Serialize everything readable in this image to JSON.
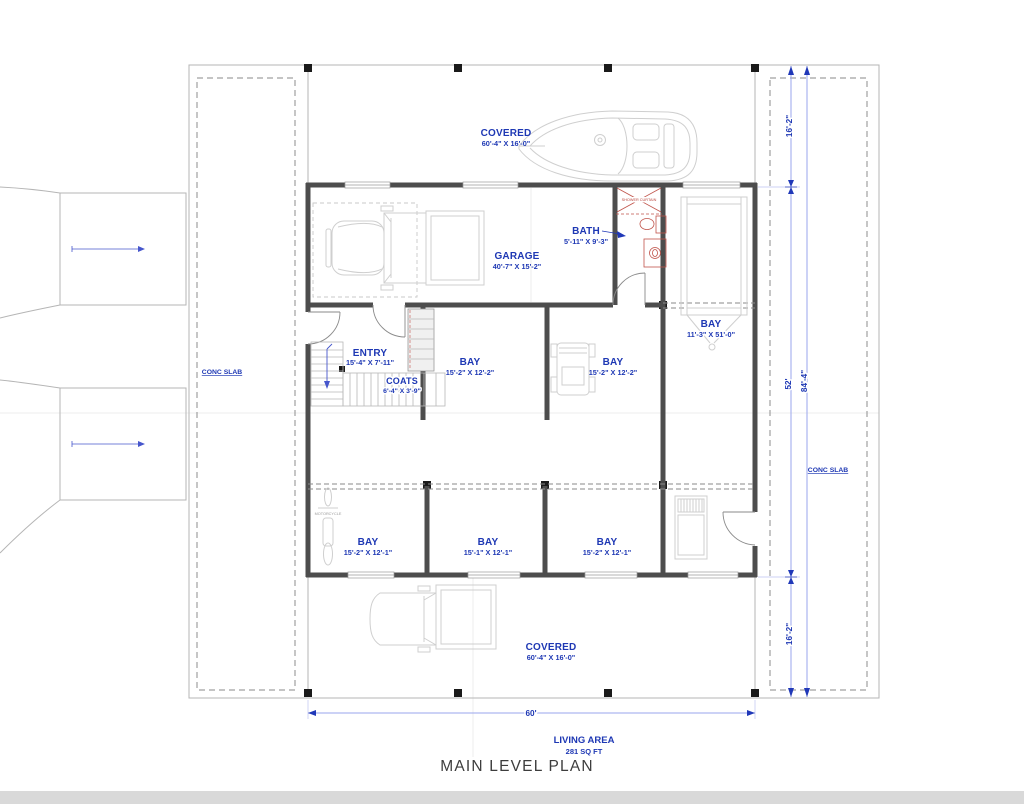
{
  "plan": {
    "title": "MAIN LEVEL PLAN",
    "living_area": {
      "label": "LIVING AREA",
      "value": "281 SQ FT"
    },
    "rooms": {
      "covered_top": {
        "name": "COVERED",
        "dims": "60'-4\" X 16'-0\""
      },
      "garage": {
        "name": "GARAGE",
        "dims": "40'-7\" X 15'-2\""
      },
      "bath": {
        "name": "BATH",
        "dims": "5'-11\" X 9'-3\""
      },
      "bay_right": {
        "name": "BAY",
        "dims": "11'-3\" X 51'-0\""
      },
      "entry": {
        "name": "ENTRY",
        "dims": "15'-4\" X 7'-11\""
      },
      "coats": {
        "name": "COATS",
        "dims": "6'-4\" X 3'-9\""
      },
      "bay_mid_left": {
        "name": "BAY",
        "dims": "15'-2\" X 12'-2\""
      },
      "bay_mid_right": {
        "name": "BAY",
        "dims": "15'-2\" X 12'-2\""
      },
      "bay_bottom_left": {
        "name": "BAY",
        "dims": "15'-2\" X 12'-1\""
      },
      "bay_bottom_center": {
        "name": "BAY",
        "dims": "15'-1\" X 12'-1\""
      },
      "bay_bottom_right": {
        "name": "BAY",
        "dims": "15'-2\" X 12'-1\""
      },
      "covered_bottom": {
        "name": "COVERED",
        "dims": "60'-4\" X 16'-0\""
      }
    },
    "dimensions": {
      "overall_width": "60'",
      "porch_top_depth": "16'-2\"",
      "main_depth": "52'",
      "overall_depth": "84'-4\"",
      "porch_bottom_depth": "16'-2\""
    },
    "annotations": {
      "conc_slab_left": "CONC SLAB",
      "conc_slab_right": "CONC SLAB",
      "shower_curtain": "SHOWER CURTAIN",
      "motorcycle_label": "MOTORCYCLE"
    },
    "colors": {
      "label_blue": "#1e38b4",
      "dim_line": "#9aa6ec",
      "wall": "#4d4d4d",
      "accent_red": "#b9453c"
    }
  }
}
